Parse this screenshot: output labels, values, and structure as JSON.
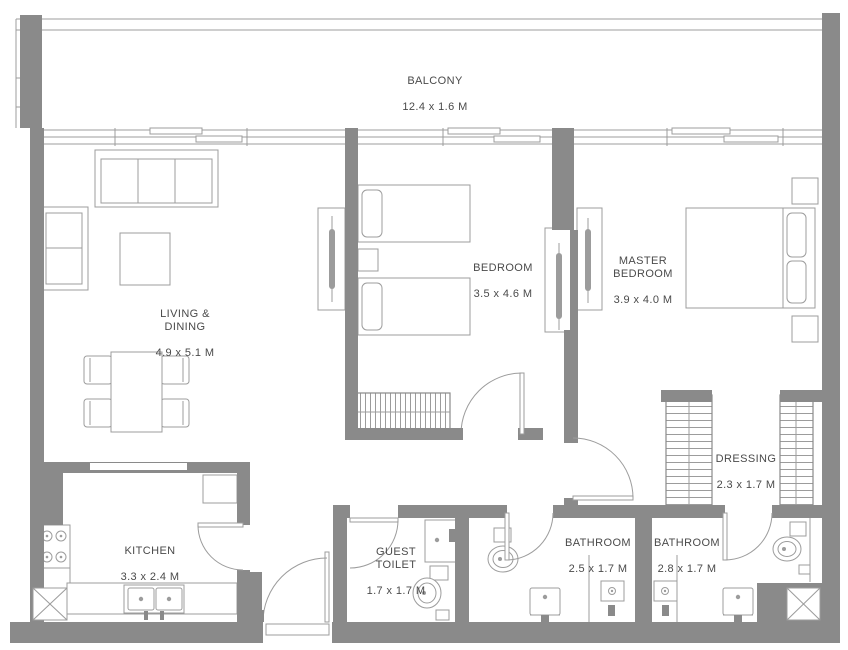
{
  "colors": {
    "wall": "#8a8a8a",
    "line": "#9c9c9c",
    "text": "#4a4a4a",
    "bg": "#ffffff"
  },
  "rooms": {
    "balcony": {
      "label": "BALCONY",
      "dims": "12.4 x 1.6 M"
    },
    "living_dining": {
      "label": "LIVING &\nDINING",
      "dims": "4.9 x 5.1 M"
    },
    "bedroom": {
      "label": "BEDROOM",
      "dims": "3.5 x 4.6 M"
    },
    "master_bedroom": {
      "label": "MASTER\nBEDROOM",
      "dims": "3.9 x 4.0 M"
    },
    "dressing": {
      "label": "DRESSING",
      "dims": "2.3 x 1.7 M"
    },
    "kitchen": {
      "label": "KITCHEN",
      "dims": "3.3 x 2.4 M"
    },
    "guest_toilet": {
      "label": "GUEST\nTOILET",
      "dims": "1.7 x 1.7 M"
    },
    "bathroom_1": {
      "label": "BATHROOM",
      "dims": "2.5 x 1.7 M"
    },
    "bathroom_2": {
      "label": "BATHROOM",
      "dims": "2.8 x 1.7 M"
    }
  }
}
